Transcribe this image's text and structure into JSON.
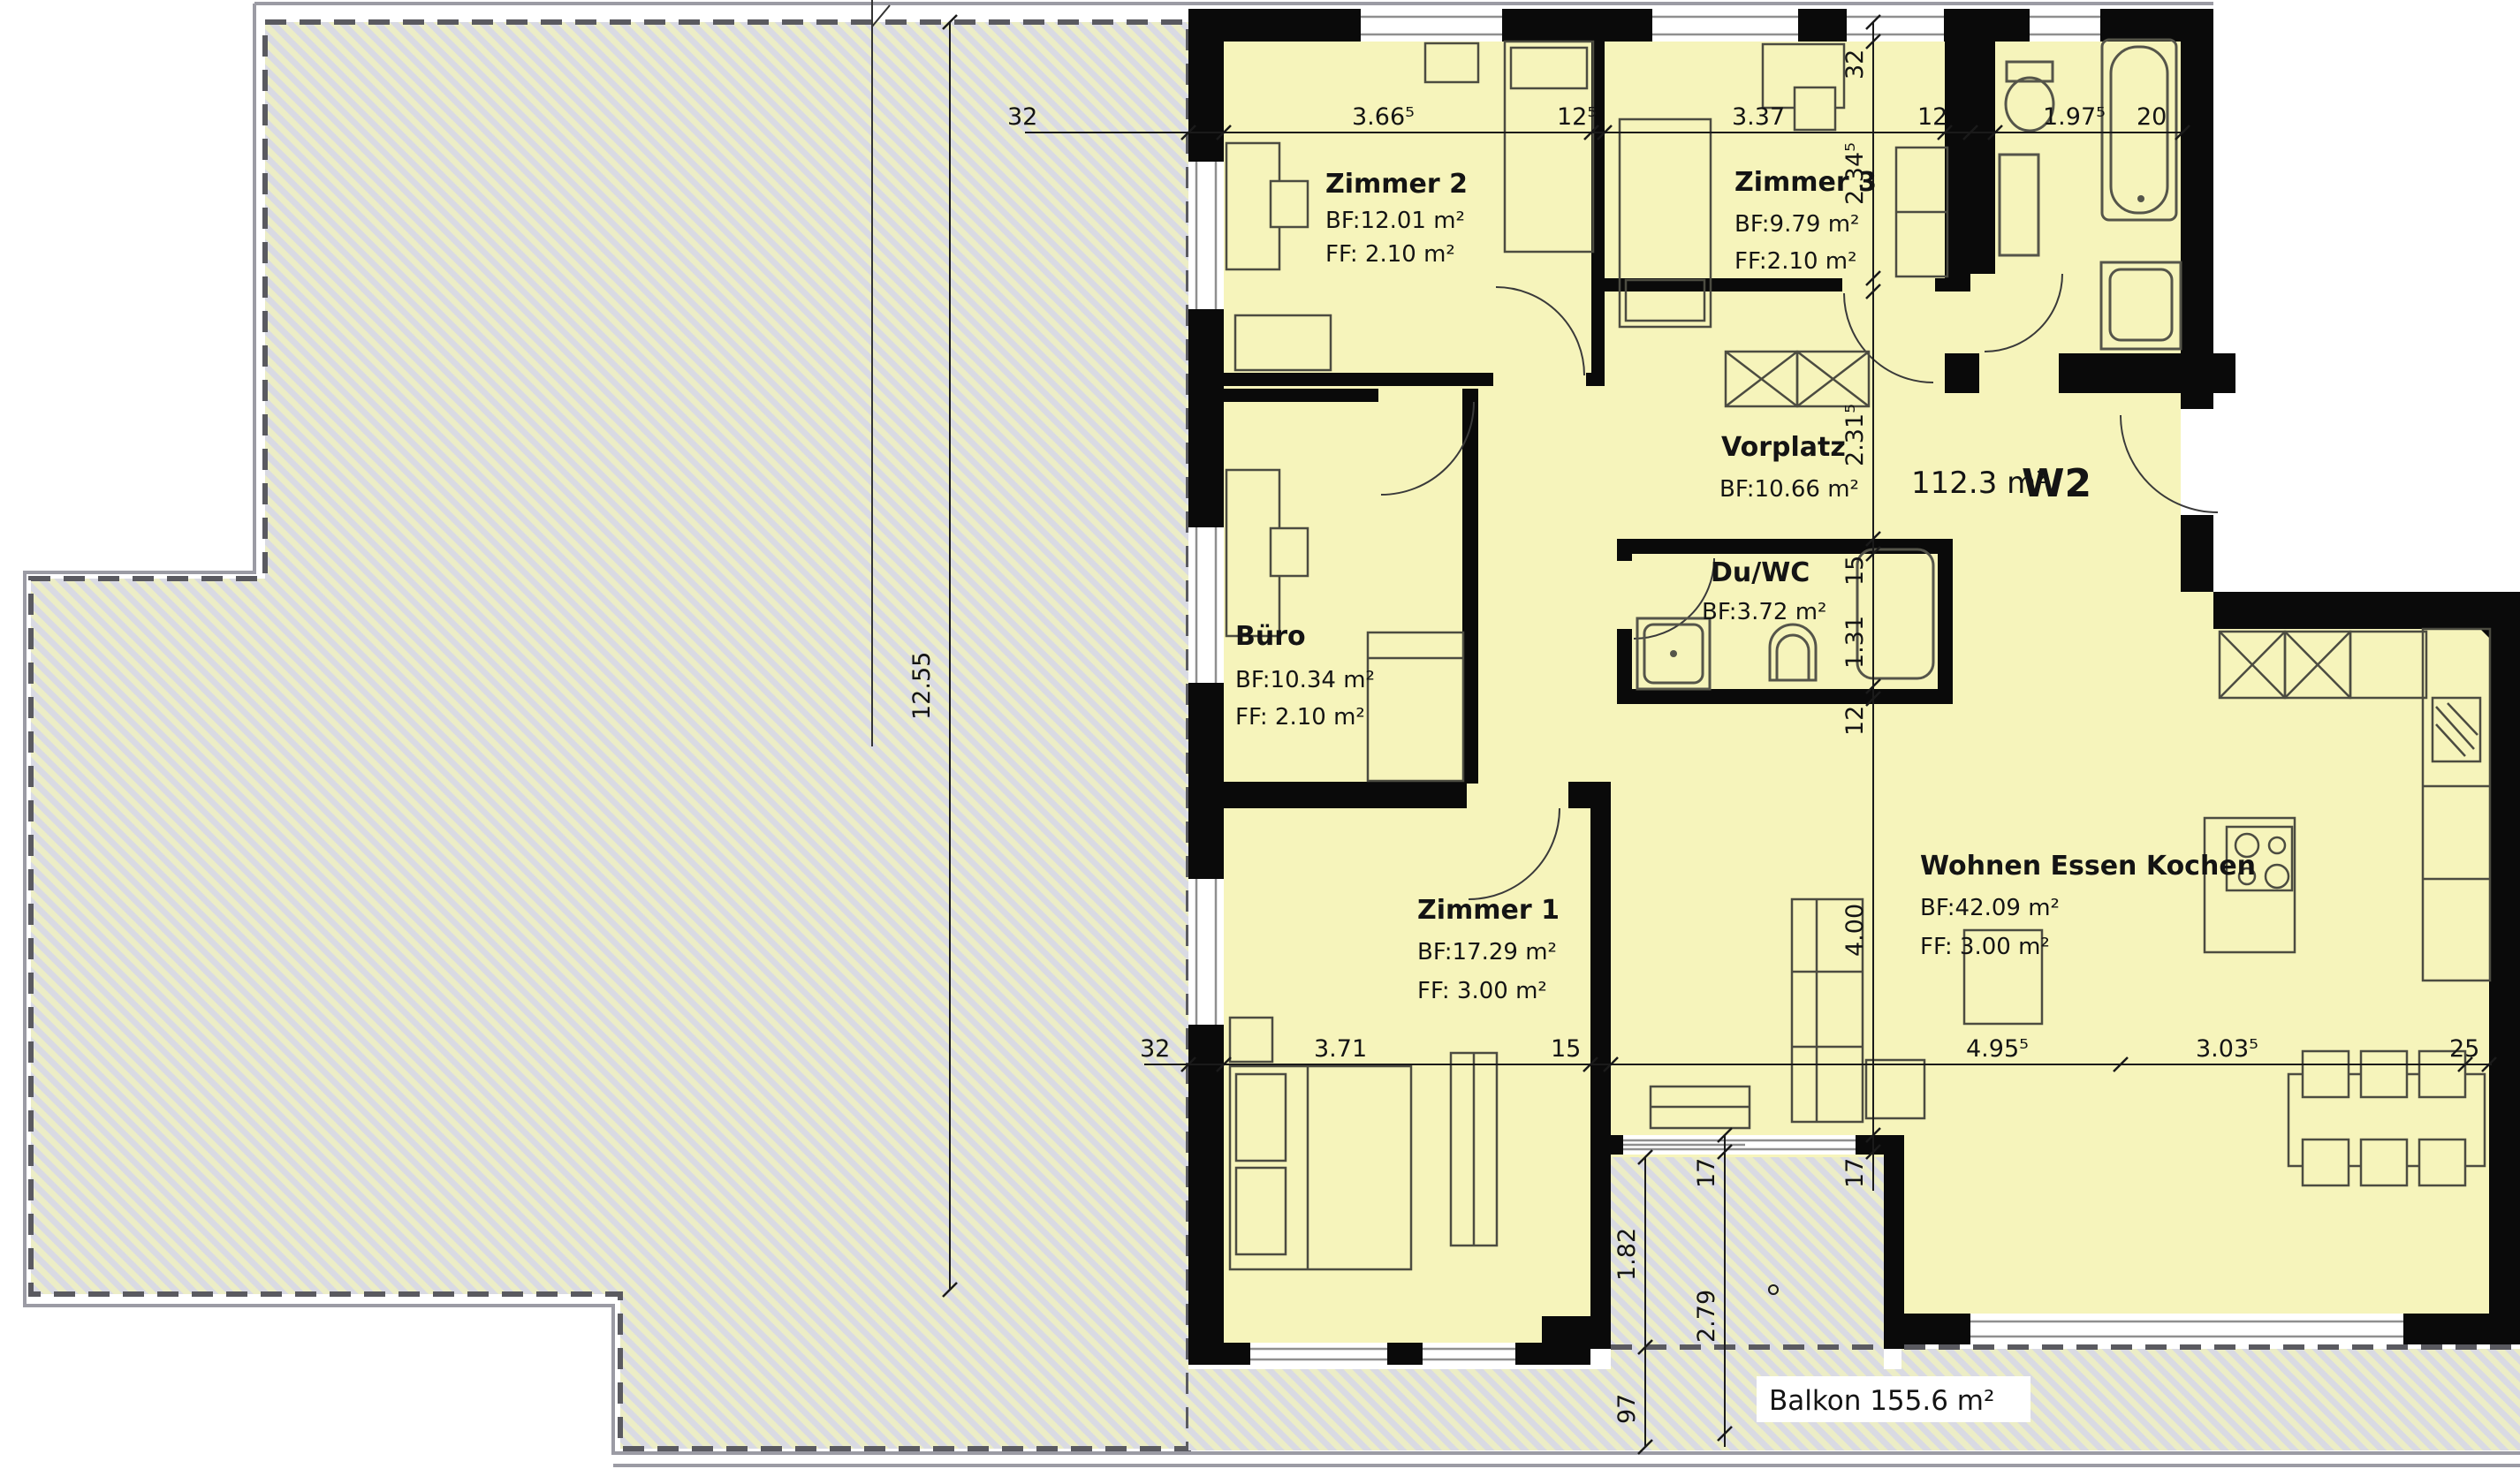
{
  "plan": {
    "unit": {
      "label": "W2",
      "area": "112.3 m²"
    },
    "balcony_label": "Balkon 155.6 m²",
    "rooms": {
      "zimmer2": {
        "name": "Zimmer 2",
        "bf": "BF:12.01 m²",
        "ff": "FF:  2.10 m²"
      },
      "zimmer3": {
        "name": "Zimmer 3",
        "bf": "BF:9.79 m²",
        "ff": "FF:2.10 m²"
      },
      "vorplatz": {
        "name": "Vorplatz",
        "bf": "BF:10.66 m²"
      },
      "buero": {
        "name": "Büro",
        "bf": "BF:10.34 m²",
        "ff": "FF:  2.10 m²"
      },
      "duwc": {
        "name": "Du/WC",
        "bf": "BF:3.72 m²"
      },
      "zimmer1": {
        "name": "Zimmer 1",
        "bf": "BF:17.29 m²",
        "ff": "FF:  3.00 m²"
      },
      "wek": {
        "name": "Wohnen Essen Kochen",
        "bf": "BF:42.09 m²",
        "ff": "FF:  3.00 m²"
      }
    },
    "dims": {
      "top": [
        "32",
        "3.66⁵",
        "12⁵",
        "3.37",
        "12",
        "1.97⁵",
        "20"
      ],
      "left": [
        "12.55"
      ],
      "right": [
        "32",
        "2.34⁵",
        "2.31⁵",
        "15",
        "1.31",
        "12",
        "4.00",
        "17"
      ],
      "bottom": [
        "32",
        "3.71",
        "15",
        "4.95⁵",
        "3.03⁵",
        "25"
      ],
      "balcony": [
        "1.82",
        "97",
        "17",
        "2.79"
      ]
    },
    "colors": {
      "room_fill": "#f6f4bb",
      "wall": "#0a0a0a",
      "unit_red": "#e3251b",
      "terrace_yellow": "#ecedc6",
      "terrace_gray": "#d9dae3"
    }
  }
}
